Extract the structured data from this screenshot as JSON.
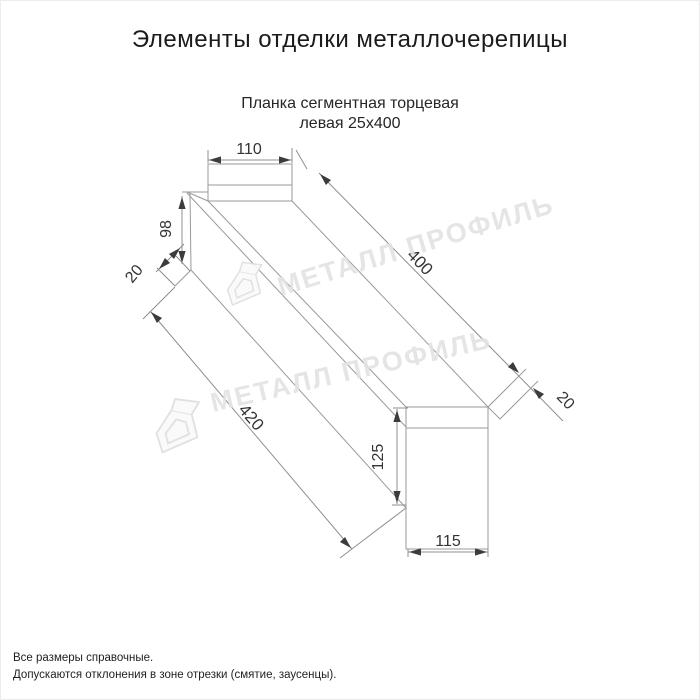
{
  "page": {
    "title": "Элементы отделки металлочерепицы"
  },
  "product": {
    "subtitle_line1": "Планка сегментная торцевая",
    "subtitle_line2": "левая 25х400"
  },
  "drawing": {
    "type": "technical-dimension-drawing",
    "dims": {
      "top_flange_width": "110",
      "left_face_height": "98",
      "left_hem": "20",
      "length_top_edge": "400",
      "length_bottom_edge": "420",
      "right_hem": "20",
      "right_face_height": "125",
      "right_bottom_width": "115"
    }
  },
  "watermark": {
    "text": "МЕТАЛЛ ПРОФИЛЬ",
    "logo": "metall-profil-house-logo"
  },
  "notes": {
    "line1": "Все размеры справочные.",
    "line2": "Допускаются отклонения в зоне отрезки (смятие, заусенцы)."
  },
  "colors": {
    "background": "#ffffff",
    "object_lines": "#9a9a9a",
    "dimension_text": "#333333",
    "watermark": "#e3e3e3",
    "title_text": "#1b1b1b"
  }
}
